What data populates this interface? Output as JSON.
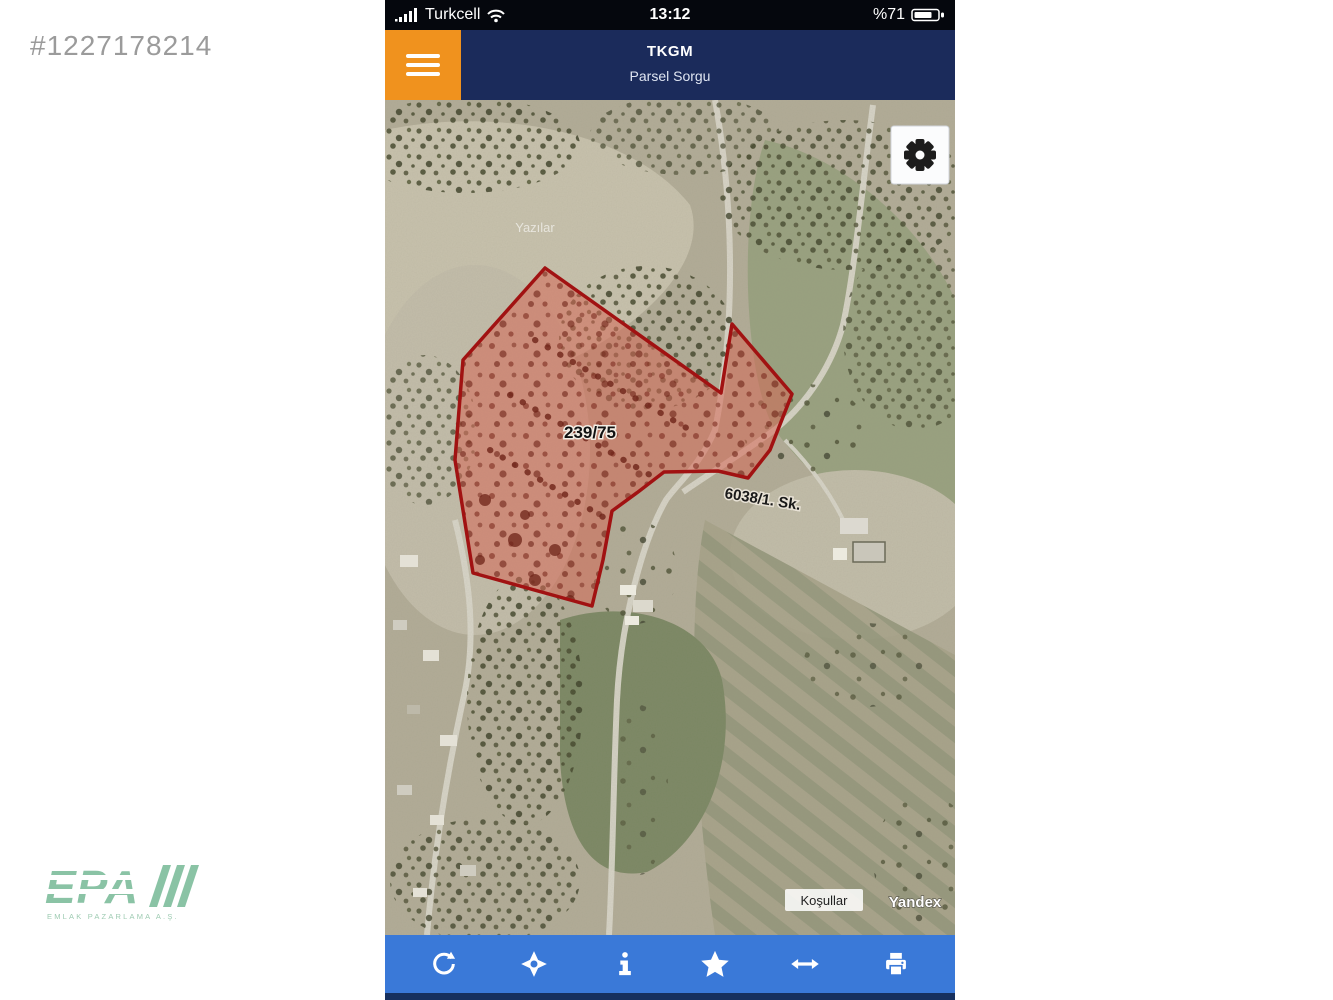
{
  "watermark": "#1227178214",
  "logo": {
    "text": "EPA",
    "subtext": "EMLAK PAZARLAMA A.Ş."
  },
  "status_bar": {
    "carrier": "Turkcell",
    "time": "13:12",
    "battery_percent": "%71"
  },
  "header": {
    "title": "TKGM",
    "subtitle": "Parsel Sorgu"
  },
  "map": {
    "parcel_number": "239/75",
    "street_label": "6038/1. Sk.",
    "place_label": "Yazılar",
    "attribution_terms": "Koşullar",
    "attribution_provider": "Yandex"
  },
  "toolbar": {
    "icons": [
      "refresh",
      "locate",
      "info",
      "favorite",
      "measure",
      "print"
    ]
  },
  "colors": {
    "header_bg": "#1b2b5b",
    "menu_button_bg": "#f0921e",
    "toolbar_bg": "#3a79d8",
    "parcel_outline": "#a11212",
    "parcel_fill": "rgba(214,104,86,0.55)",
    "logo_green": "#8ac3a5"
  }
}
